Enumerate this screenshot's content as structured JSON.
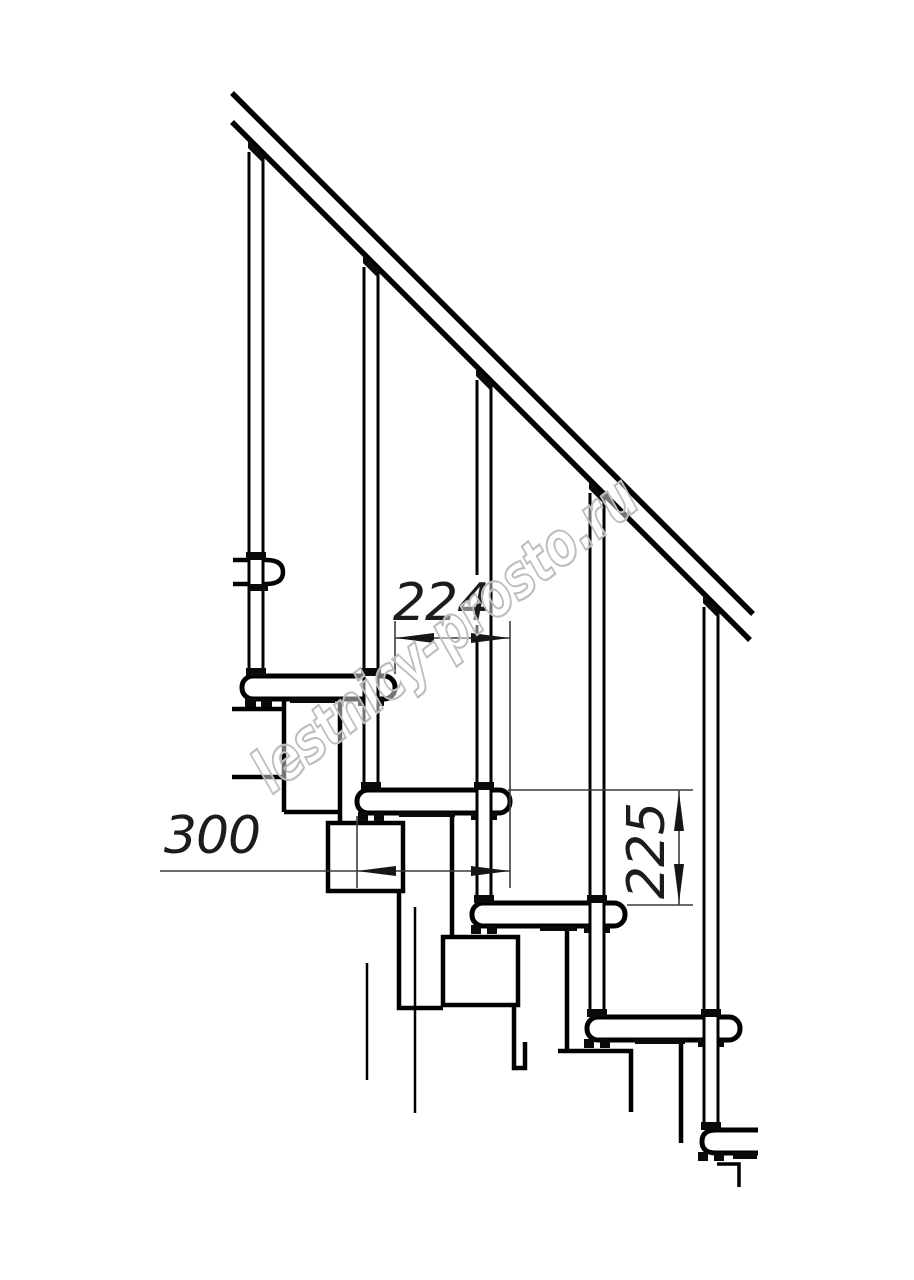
{
  "drawing": {
    "dimensions": {
      "run_label": "224",
      "depth_label": "300",
      "riser_label": "225"
    },
    "watermark": {
      "text": "lestnicy-prosto.ru"
    },
    "colors": {
      "line": "#000000",
      "dimension": "#3c3c3c",
      "dimension_text": "#1c1c1c",
      "watermark": "#bdbdbd",
      "background": "#ffffff"
    },
    "structure": {
      "treads_visible": 5,
      "balusters_visible": 5,
      "has_handrail": true
    }
  }
}
